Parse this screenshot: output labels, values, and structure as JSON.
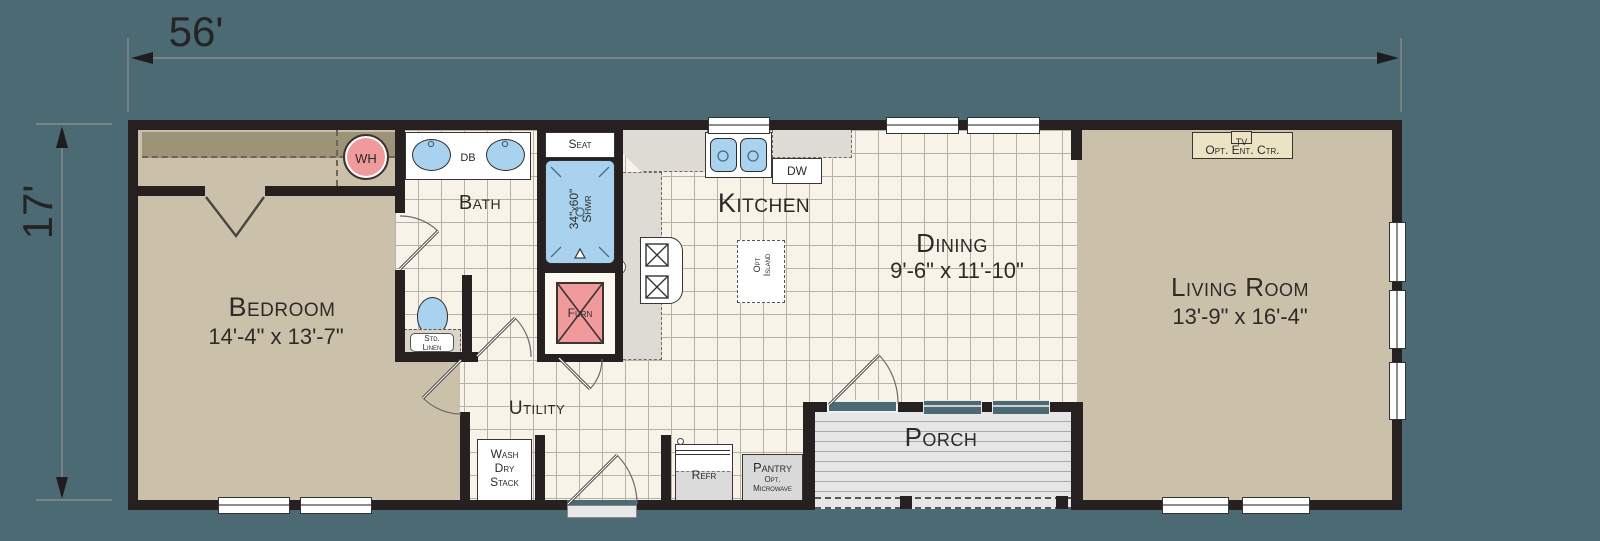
{
  "plan": {
    "overall_width": "56'",
    "overall_height": "17'"
  },
  "rooms": {
    "bedroom": {
      "label": "Bedroom",
      "dims": "14'-4\" x 13'-7\""
    },
    "bath": {
      "label": "Bath"
    },
    "kitchen": {
      "label": "Kitchen"
    },
    "dining": {
      "label": "Dining",
      "dims": "9'-6\" x 11'-10\""
    },
    "living": {
      "label": "Living Room",
      "dims": "13'-9\" x 16'-4\""
    },
    "utility": {
      "label": "Utility"
    },
    "porch": {
      "label": "Porch"
    }
  },
  "fixtures": {
    "water_heater": "WH",
    "double_bowl": "DB",
    "dishwasher": "DW",
    "shower_seat": "Seat",
    "shower_size": "34\"x60\"",
    "shower_abbr": "Shwr",
    "furnace": "Furn",
    "linen_line1": "Std.",
    "linen_line2": "Linen",
    "washer_line1": "Wash",
    "washer_line2": "Dry",
    "washer_line3": "Stack",
    "refrigerator": "Refr",
    "pantry": "Pantry",
    "pantry_opt": "Opt.",
    "pantry_microwave": "Microwave",
    "tv": "TV",
    "ent_center": "Opt. Ent. Ctr.",
    "island_line1": "Opt",
    "island_line2": "Island"
  },
  "colors": {
    "bg": "#4B6A73",
    "wall": "#262120",
    "carpet": "#CBC1AA",
    "closet_shelf": "#9D9377",
    "tile": "#F7F3E8",
    "tileline": "#B7B2A3",
    "counter": "#DDDBD4",
    "blue": "#A8D2EE",
    "pink": "#F19A9C",
    "porch": "#E6E6E6",
    "entctr": "#EBE3C4",
    "text": "#2E2A28"
  }
}
